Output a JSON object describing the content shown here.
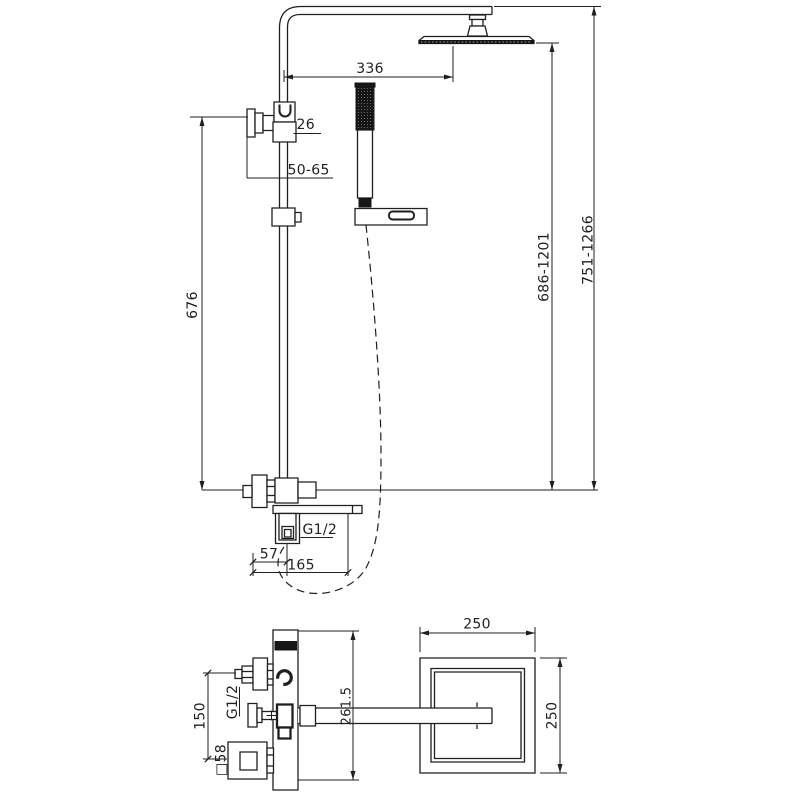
{
  "title": "Thermostatic shower column technical drawing",
  "colors": {
    "ink": "#1f1f1f",
    "bg": "#ffffff"
  },
  "front_view": {
    "dim_arm_length": "336",
    "dim_pipe_width": "26",
    "dim_wall_distance": "50-65",
    "dim_rail_height": "676",
    "dim_head_height_range": "686-1201",
    "dim_total_height_range": "751-1266",
    "thread_label": "G1/2",
    "dim_outlet_offset": "57",
    "dim_spout_length": "165"
  },
  "top_view": {
    "dim_head_width": "250",
    "dim_head_depth": "250",
    "dim_arm_projection": "261.5",
    "dim_inlet_spacing": "150",
    "thread_label": "G1/2",
    "dim_escutcheon": "□58"
  }
}
